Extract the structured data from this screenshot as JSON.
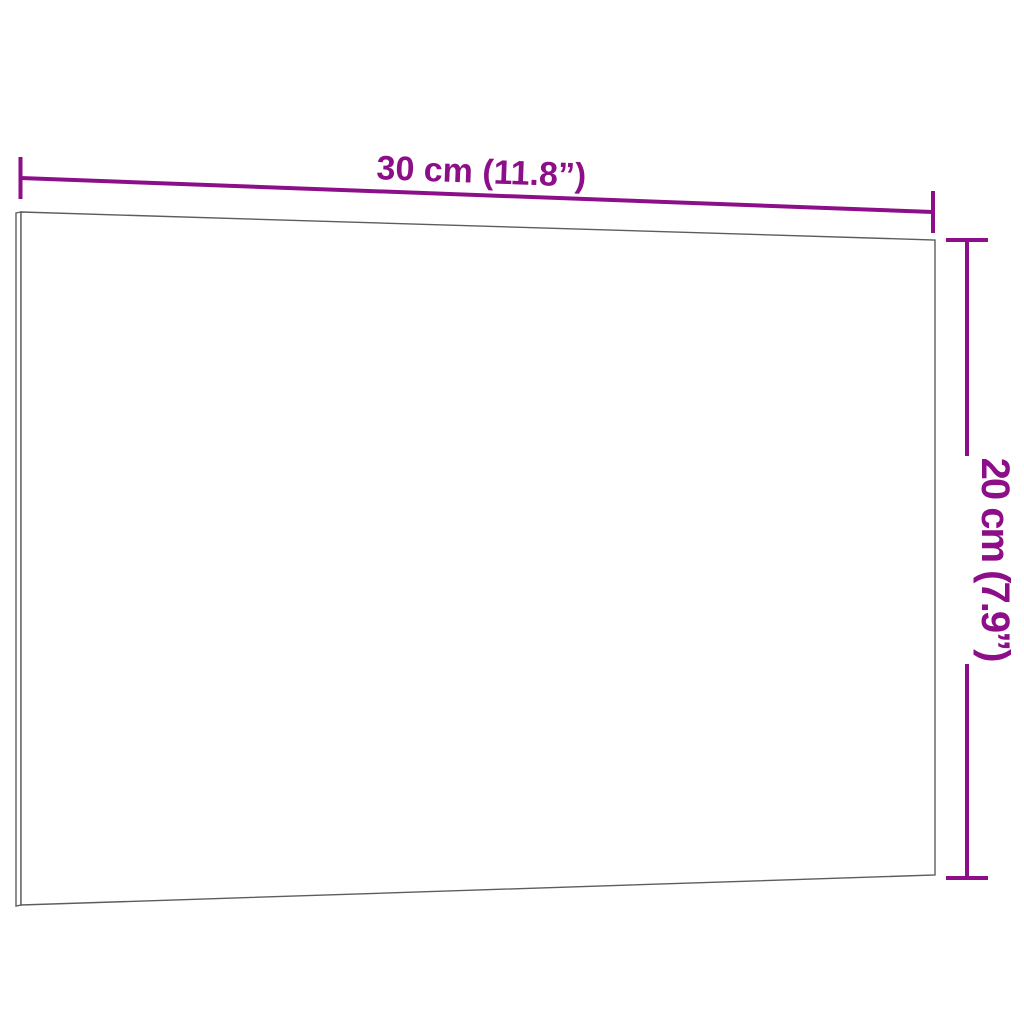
{
  "product_diagram": {
    "type": "dimension-diagram",
    "width_label": "30 cm (11.8”)",
    "height_label": "20 cm (7.9”)",
    "colors": {
      "dimension": "#8D0E89",
      "board_outline": "#5D5D5D",
      "background": "#FFFFFF"
    }
  }
}
